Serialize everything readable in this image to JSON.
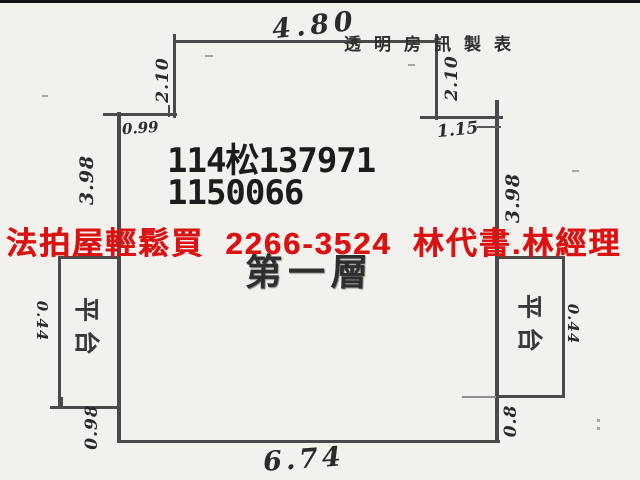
{
  "colors": {
    "background": "#f2f1ed",
    "wall_line": "#4a4a4a",
    "handwriting_ink": "#2b2b2b",
    "case_number_ink": "#1c1c1c",
    "ad_red": "#db1212"
  },
  "watermark": "透明房訊製表",
  "case_numbers": {
    "line1": "114松137971",
    "line2": "1150066"
  },
  "ad_overlay": "法拍屋輕鬆買  2266-3524  林代書.林經理",
  "floor_label": "第一層",
  "platforms": {
    "left": "平台",
    "right": "平台"
  },
  "dimensions": {
    "top_width": "4.80",
    "bottom_width": "6.74",
    "left_upper_height": "2.10",
    "right_upper_height": "2.10",
    "left_step_width": "0.99",
    "right_step_width": "1.15",
    "left_wall_height": "3.98",
    "right_wall_height": "3.98",
    "left_platform_width": "0.44",
    "right_platform_width": "0.44",
    "left_lower_height": "0.98",
    "right_lower_height": "0.8"
  }
}
